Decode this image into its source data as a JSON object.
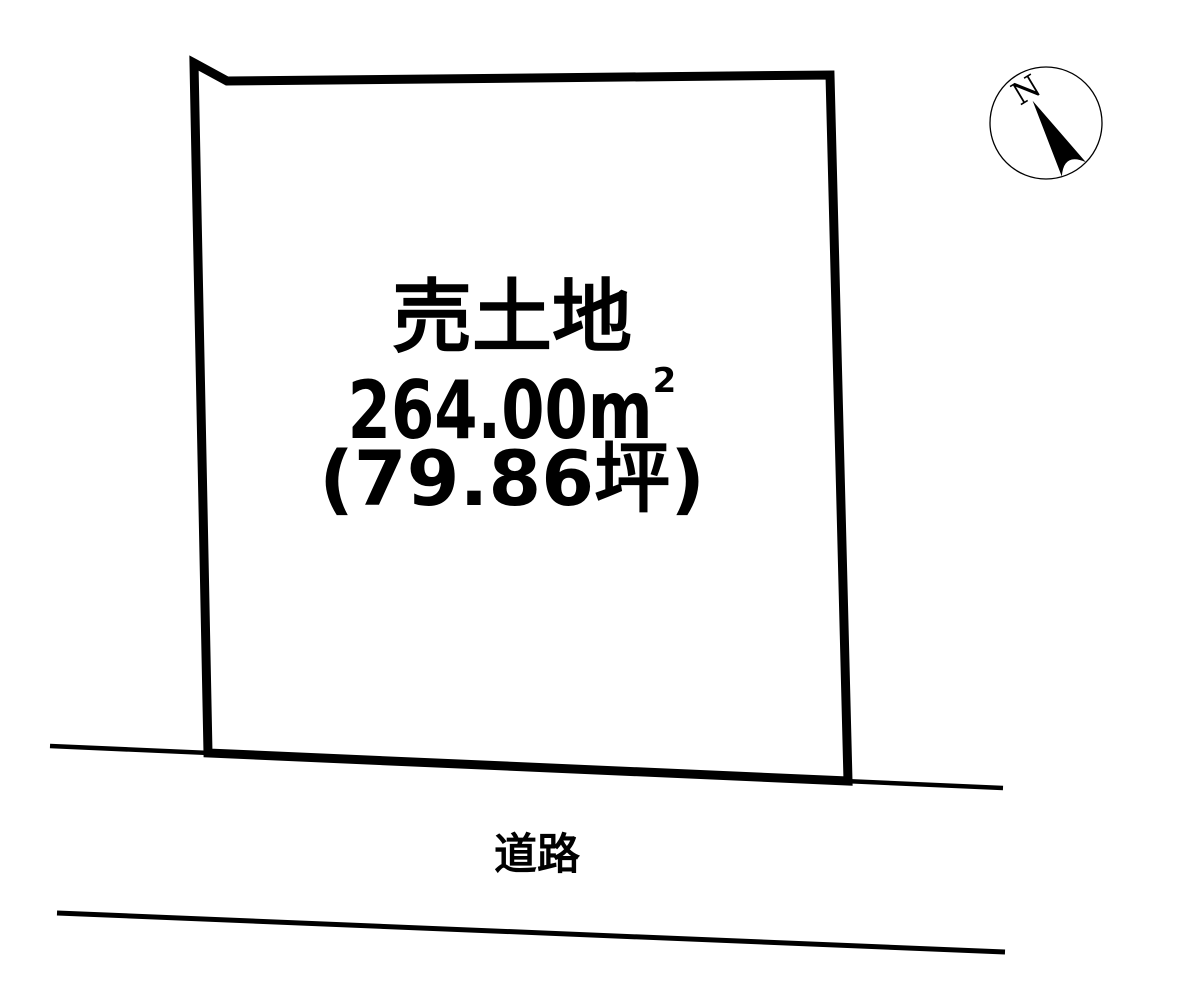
{
  "meta": {
    "background_color": "#ffffff",
    "line_color": "#000000"
  },
  "parcel": {
    "title": "売土地",
    "area_main": "264.00m",
    "area_sup": "2",
    "area_tsubo": "(79.86坪)"
  },
  "road": {
    "label": "道路"
  },
  "compass": {
    "north_label": "N"
  }
}
